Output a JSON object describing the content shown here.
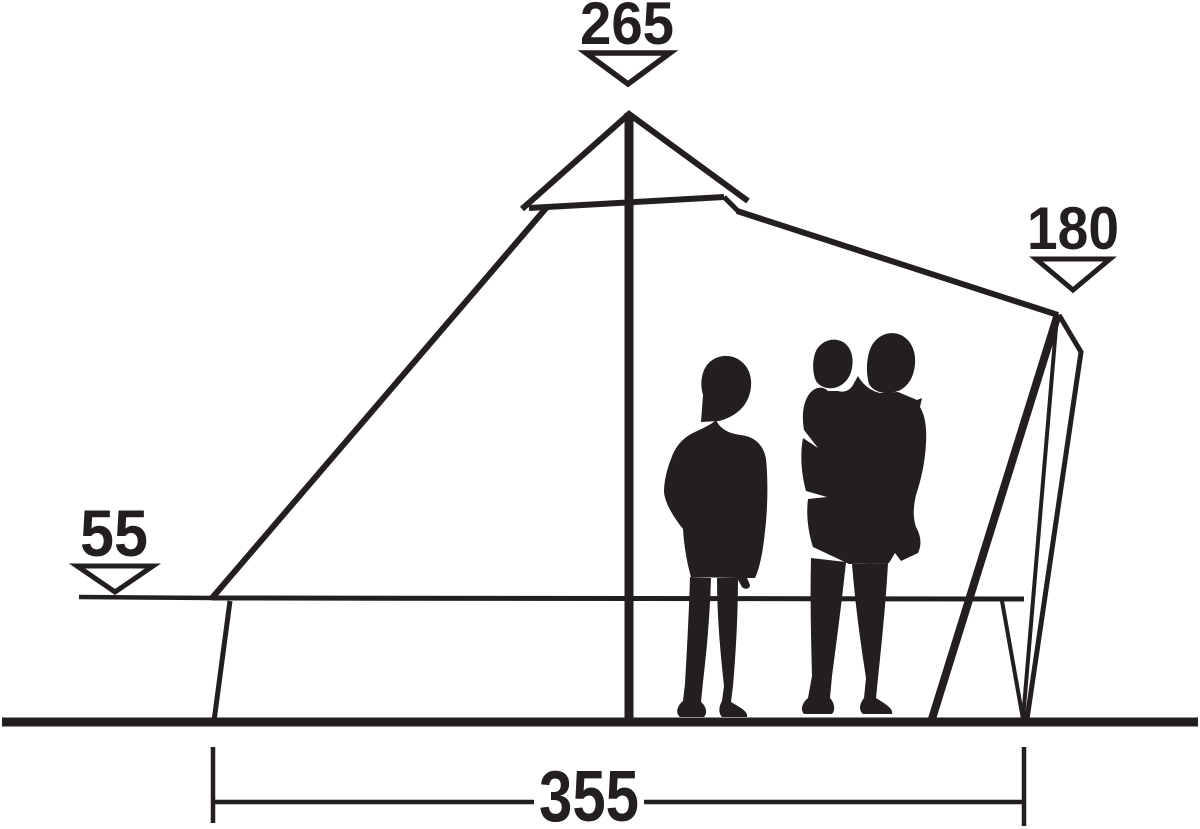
{
  "diagram": {
    "background": "#ffffff",
    "ink": "#231f20",
    "dimensions": {
      "peak_height": "265",
      "entrance_height": "180",
      "side_wall_height": "55",
      "floor_width": "355"
    }
  }
}
